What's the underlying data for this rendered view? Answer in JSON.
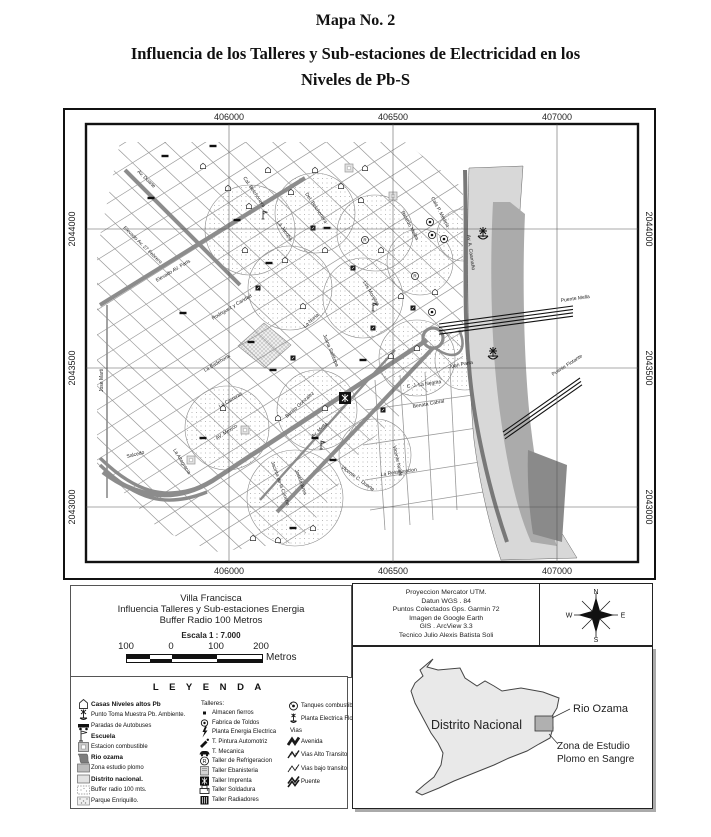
{
  "page": {
    "map_number": "Mapa No. 2",
    "title_line1": "Influencia de los Talleres y Sub-estaciones de Electricidad en los",
    "title_line2": "Niveles de Pb-S"
  },
  "colors": {
    "road": "#8c8c8c",
    "road_dark": "#787878",
    "street": "#9a9a9a",
    "river_light": "#d8d8d8",
    "river_mid": "#ababab",
    "river_dark": "#8a8a8a",
    "buffer_dot": "#9a9a9a",
    "ink": "#111111"
  },
  "map": {
    "axis": {
      "top": [
        "406000",
        "406500",
        "407000"
      ],
      "bottom": [
        "406000",
        "406500",
        "407000"
      ],
      "left": [
        "2044000",
        "2043500",
        "2043000"
      ],
      "right": [
        "2044000",
        "2043500",
        "2043000"
      ]
    },
    "street_labels": [
      {
        "text": "Av. Duarte",
        "x": 72,
        "y": 62,
        "r": 44
      },
      {
        "text": "Elevado Av. 27 Febrero",
        "x": 58,
        "y": 118,
        "r": 44
      },
      {
        "text": "Elevado AV. Paris",
        "x": 92,
        "y": 172,
        "r": -31
      },
      {
        "text": "Jose Marti",
        "x": 38,
        "y": 282,
        "r": -90
      },
      {
        "text": "Rodriguez y Caridad",
        "x": 148,
        "y": 210,
        "r": -31
      },
      {
        "text": "La Badehona",
        "x": 140,
        "y": 262,
        "r": -31
      },
      {
        "text": "La Carreras",
        "x": 155,
        "y": 298,
        "r": -31
      },
      {
        "text": "La Altagracia",
        "x": 108,
        "y": 340,
        "r": 58
      },
      {
        "text": "Salcedo",
        "x": 62,
        "y": 348,
        "r": -14
      },
      {
        "text": "AV. Mexico",
        "x": 152,
        "y": 330,
        "r": -33
      },
      {
        "text": "Av. Mella",
        "x": 248,
        "y": 328,
        "r": -42
      },
      {
        "text": "Benito Gonzalez",
        "x": 222,
        "y": 308,
        "r": -42
      },
      {
        "text": "Jacinto de la Concha",
        "x": 206,
        "y": 352,
        "r": 70
      },
      {
        "text": "Josefa Brea",
        "x": 230,
        "y": 360,
        "r": 70
      },
      {
        "text": "Juana Saltitopa",
        "x": 258,
        "y": 225,
        "r": 68
      },
      {
        "text": "Vicente C. Duarte",
        "x": 276,
        "y": 358,
        "r": 36
      },
      {
        "text": "La Restauracion",
        "x": 316,
        "y": 366,
        "r": -8
      },
      {
        "text": "Vicente Noble",
        "x": 328,
        "y": 336,
        "r": 78
      },
      {
        "text": "Benata Cabral",
        "x": 348,
        "y": 298,
        "r": -10
      },
      {
        "text": "C. J. La Negrita",
        "x": 342,
        "y": 278,
        "r": -8
      },
      {
        "text": "Juan Parra",
        "x": 384,
        "y": 258,
        "r": -10
      },
      {
        "text": "La Jacoba",
        "x": 212,
        "y": 112,
        "r": 56
      },
      {
        "text": "Cal. Belchonera",
        "x": 178,
        "y": 68,
        "r": 56
      },
      {
        "text": "Del. Belchonera",
        "x": 240,
        "y": 84,
        "r": 56
      },
      {
        "text": "La Noria",
        "x": 240,
        "y": 218,
        "r": -42
      },
      {
        "text": "Los Monjitas",
        "x": 298,
        "y": 172,
        "r": 60
      },
      {
        "text": "Ricardo Melba",
        "x": 336,
        "y": 102,
        "r": 62
      },
      {
        "text": "Cala P. Medina",
        "x": 366,
        "y": 88,
        "r": 62
      },
      {
        "text": "Av. A. Caamaño",
        "x": 402,
        "y": 125,
        "r": 82
      },
      {
        "text": "Puente Mella",
        "x": 496,
        "y": 192,
        "r": -8
      },
      {
        "text": "Puente Flotante",
        "x": 488,
        "y": 266,
        "r": -33
      }
    ],
    "icons": {
      "bus_stops": [
        [
          100,
          46
        ],
        [
          86,
          88
        ],
        [
          148,
          36
        ],
        [
          172,
          110
        ],
        [
          118,
          203
        ],
        [
          186,
          232
        ],
        [
          208,
          260
        ],
        [
          138,
          328
        ],
        [
          250,
          328
        ],
        [
          228,
          418
        ],
        [
          268,
          350
        ],
        [
          298,
          250
        ],
        [
          204,
          153
        ],
        [
          262,
          118
        ]
      ],
      "houses": [
        [
          138,
          56
        ],
        [
          163,
          78
        ],
        [
          184,
          96
        ],
        [
          203,
          60
        ],
        [
          226,
          82
        ],
        [
          250,
          60
        ],
        [
          276,
          76
        ],
        [
          180,
          140
        ],
        [
          220,
          150
        ],
        [
          260,
          140
        ],
        [
          296,
          90
        ],
        [
          316,
          140
        ],
        [
          238,
          196
        ],
        [
          336,
          186
        ],
        [
          300,
          58
        ],
        [
          326,
          246
        ],
        [
          260,
          298
        ],
        [
          213,
          308
        ],
        [
          188,
          428
        ],
        [
          213,
          430
        ],
        [
          248,
          418
        ],
        [
          158,
          298
        ],
        [
          352,
          238
        ],
        [
          370,
          182
        ]
      ],
      "tanks": [
        [
          365,
          112
        ],
        [
          367,
          125
        ],
        [
          379,
          129
        ],
        [
          367,
          202
        ]
      ],
      "anchors": [
        [
          418,
          126
        ],
        [
          428,
          246
        ]
      ],
      "gray_squares": [
        [
          328,
          86
        ],
        [
          126,
          350
        ],
        [
          180,
          320
        ],
        [
          284,
          58
        ]
      ],
      "black_squares": [
        [
          248,
          118
        ],
        [
          288,
          158
        ],
        [
          308,
          218
        ],
        [
          228,
          248
        ],
        [
          193,
          178
        ],
        [
          348,
          198
        ],
        [
          318,
          300
        ]
      ],
      "flags": [
        [
          198,
          106
        ],
        [
          308,
          198
        ],
        [
          256,
          336
        ]
      ],
      "circle_r": [
        [
          350,
          166
        ],
        [
          300,
          130
        ]
      ],
      "imprenta": [
        [
          280,
          288
        ]
      ]
    }
  },
  "info_box": {
    "line1": "Villa  Francisca",
    "line2": "Influencia Talleres y Sub-estaciones  Energia",
    "line3": "Buffer Radio 100 Metros",
    "scale_label": "Escala 1 : 7.000",
    "scale_ticks": [
      "100",
      "0",
      "100",
      "200"
    ],
    "scale_unit": "Metros"
  },
  "projection_box": {
    "lines": [
      "Proyeccion  Mercator UTM.",
      "Datun WGS . 84",
      "Puntos Colectados Gps. Garmin 72",
      "Imagen de Google Earth",
      "GIS . ArcView 3.3",
      "Tecnico Julio Alexis Batista Soli"
    ]
  },
  "compass": {
    "n": "N",
    "s": "S",
    "e": "E",
    "w": "W"
  },
  "legend": {
    "title": "L E Y E N D A",
    "left": [
      {
        "icon": "house",
        "label": "Casas Niveles altos Pb",
        "bold": true
      },
      {
        "icon": "anchor",
        "label": "Punto Toma Muestra Pb. Ambiente.",
        "bold": false
      },
      {
        "icon": "bus",
        "label": "Paradas de Autobuses",
        "bold": false
      },
      {
        "icon": "flag",
        "label": "Escuela",
        "bold": true
      },
      {
        "icon": "station",
        "label": "Estacion combustible",
        "bold": false
      },
      {
        "icon": "swatch-river",
        "label": "Rio ozama",
        "bold": true
      },
      {
        "icon": "swatch-zona",
        "label": "Zona estudio plomo",
        "bold": false
      },
      {
        "icon": "swatch-distrito",
        "label": "Distrito nacional.",
        "bold": true
      },
      {
        "icon": "swatch-buffer",
        "label": "Buffer radio 100 mts.",
        "bold": false
      },
      {
        "icon": "swatch-parque",
        "label": "Parque Enriquillo.",
        "bold": false
      }
    ],
    "middle_header": "Talleres:",
    "middle": [
      {
        "icon": "dot",
        "label": "Almacen fierros",
        "bold": false
      },
      {
        "icon": "circle-dot",
        "label": "Fabrica de Toldos",
        "bold": false
      },
      {
        "icon": "bolt",
        "label": "Planta Energia Electrica",
        "bold": false
      },
      {
        "icon": "paint",
        "label": "T. Pintura Automotriz",
        "bold": false
      },
      {
        "icon": "car",
        "label": "T. Mecanica",
        "bold": false
      },
      {
        "icon": "circle-r",
        "label": "Taller de Refrigeracion",
        "bold": false
      },
      {
        "icon": "square-gray",
        "label": "Taller Ebanisteria",
        "bold": false
      },
      {
        "icon": "square-ornate",
        "label": "Taller Imprenta",
        "bold": false
      },
      {
        "icon": "printer",
        "label": "Taller Soldadura",
        "bold": false
      },
      {
        "icon": "grid-square",
        "label": "Taller Radiadores",
        "bold": false
      }
    ],
    "right_top": [
      {
        "icon": "tank-big",
        "label": "Tanques combustibles.",
        "bold": false
      },
      {
        "icon": "anchor-star",
        "label": "Planta Electrica Flotante",
        "bold": false
      }
    ],
    "vias_header": "Vias",
    "vias": [
      {
        "icon": "zigzag-thick",
        "label": "Avenida",
        "bold": false
      },
      {
        "icon": "zigzag-med",
        "label": "Vias Alto Transito",
        "bold": false
      },
      {
        "icon": "zigzag-thin",
        "label": "Vias bajo transito",
        "bold": false
      },
      {
        "icon": "zigzag-double",
        "label": "Puente",
        "bold": false
      }
    ]
  },
  "inset": {
    "region_label": "Distrito Nacional",
    "river_label": "Rio Ozama",
    "zone_label_line1": "Zona de Estudio",
    "zone_label_line2": "Plomo en Sangre"
  }
}
